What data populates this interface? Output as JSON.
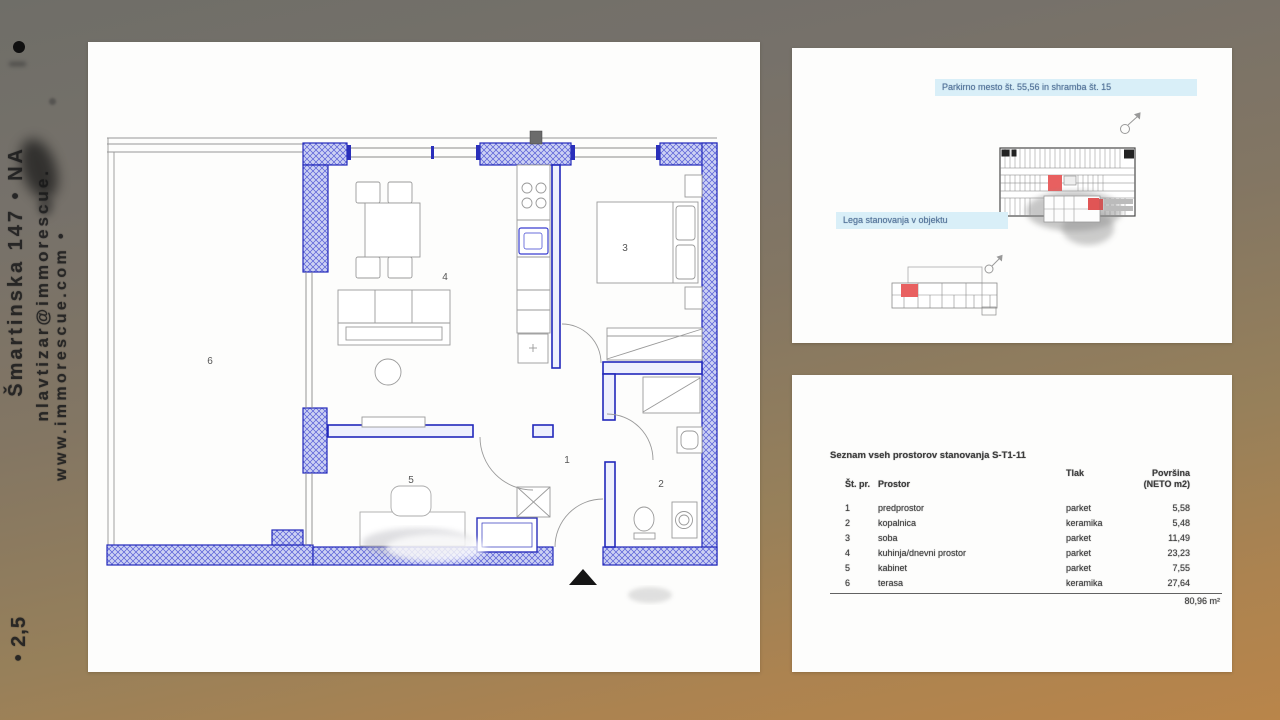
{
  "left_sidebar": {
    "line1": "Šmartinska 147 • NA",
    "line2": "nlavtizar@immorescue.",
    "line3": "www.immorescue.com •",
    "scale_note": "• 2,5"
  },
  "floor_plan": {
    "rooms": [
      "1",
      "2",
      "3",
      "4",
      "5",
      "6"
    ]
  },
  "location_panel": {
    "parking_label": "Parkirno mesto št. 55,56 in shramba št. 15",
    "location_label": "Lega stanovanja v objektu"
  },
  "area_table": {
    "title": "Seznam vseh prostorov stanovanja S-T1-11",
    "headers": {
      "num": "Št. pr.",
      "room": "Prostor",
      "floor": "Tlak",
      "area_line1": "Površina",
      "area_line2": "(NETO m2)"
    },
    "rows": [
      {
        "num": "1",
        "room": "predprostor",
        "floor": "parket",
        "area": "5,58"
      },
      {
        "num": "2",
        "room": "kopalnica",
        "floor": "keramika",
        "area": "5,48"
      },
      {
        "num": "3",
        "room": "soba",
        "floor": "parket",
        "area": "11,49"
      },
      {
        "num": "4",
        "room": "kuhinja/dnevni prostor",
        "floor": "parket",
        "area": "23,23"
      },
      {
        "num": "5",
        "room": "kabinet",
        "floor": "parket",
        "area": "7,55"
      },
      {
        "num": "6",
        "room": "terasa",
        "floor": "keramika",
        "area": "27,64"
      }
    ],
    "total": "80,96 m²"
  }
}
